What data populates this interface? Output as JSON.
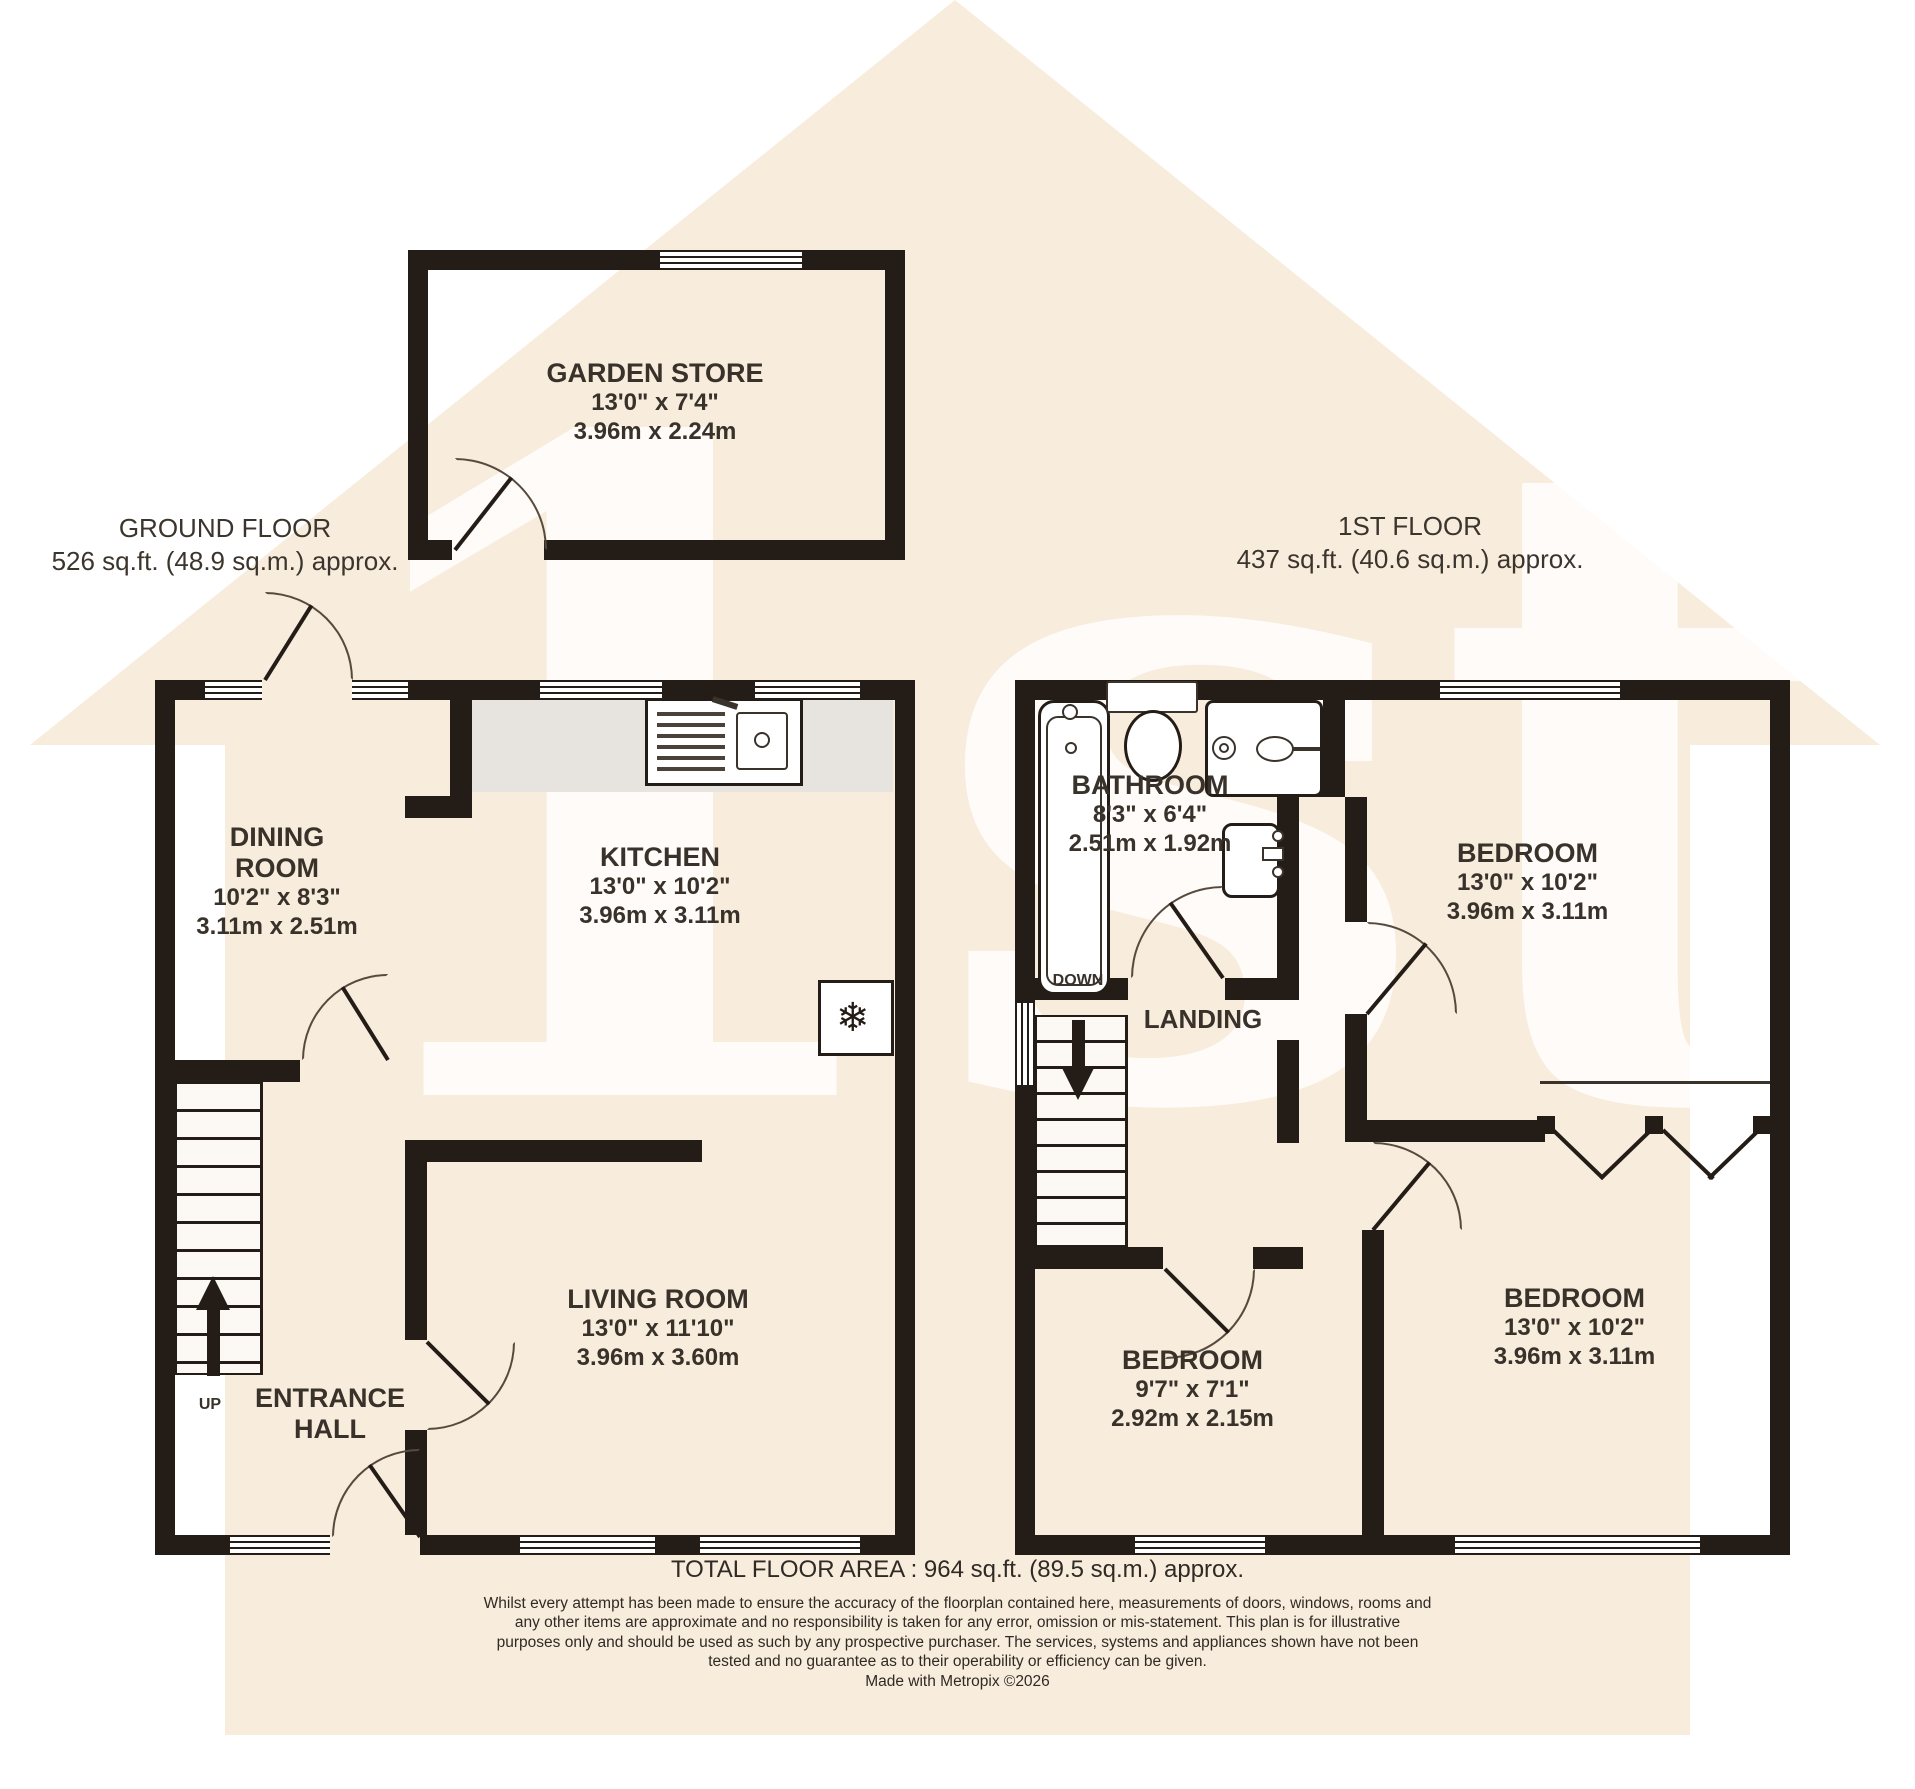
{
  "watermark": {
    "text": "1st"
  },
  "headings": {
    "ground": {
      "title": "GROUND FLOOR",
      "area": "526 sq.ft. (48.9 sq.m.) approx."
    },
    "first": {
      "title": "1ST FLOOR",
      "area": "437 sq.ft. (40.6 sq.m.) approx."
    }
  },
  "rooms": {
    "garden_store": {
      "name": "GARDEN STORE",
      "imperial": "13'0\" x 7'4\"",
      "metric": "3.96m x 2.24m"
    },
    "dining_room": {
      "name": "DINING ROOM",
      "imperial": "10'2\" x 8'3\"",
      "metric": "3.11m x 2.51m"
    },
    "kitchen": {
      "name": "KITCHEN",
      "imperial": "13'0\" x 10'2\"",
      "metric": "3.96m x 3.11m"
    },
    "living_room": {
      "name": "LIVING ROOM",
      "imperial": "13'0\" x 11'10\"",
      "metric": "3.96m x 3.60m"
    },
    "entrance_hall": {
      "name": "ENTRANCE HALL"
    },
    "bathroom": {
      "name": "BATHROOM",
      "imperial": "8'3\" x 6'4\"",
      "metric": "2.51m x 1.92m"
    },
    "bedroom_front": {
      "name": "BEDROOM",
      "imperial": "13'0\" x 10'2\"",
      "metric": "3.96m x 3.11m"
    },
    "bedroom_middle": {
      "name": "BEDROOM",
      "imperial": "9'7\" x 7'1\"",
      "metric": "2.92m x 2.15m"
    },
    "bedroom_back": {
      "name": "BEDROOM",
      "imperial": "13'0\" x 10'2\"",
      "metric": "3.96m x 3.11m"
    },
    "landing": {
      "name": "LANDING"
    }
  },
  "stairs": {
    "up": "UP",
    "down": "DOWN"
  },
  "icons": {
    "snowflake": "❄"
  },
  "footer": {
    "total": "TOTAL FLOOR AREA : 964 sq.ft. (89.5 sq.m.) approx.",
    "disclaimer": "Whilst every attempt has been made to ensure the accuracy of the floorplan contained here, measurements of doors, windows, rooms and any other items are approximate and no responsibility is taken for any error, omission or mis-statement. This plan is for illustrative purposes only and should be used as such by any prospective purchaser. The services, systems and appliances shown have not been tested and no guarantee as to their operability or efficiency can be given.",
    "credit": "Made with Metropix ©2026"
  },
  "colors": {
    "wall": "#241d17",
    "watermark": "#f8ecdc",
    "counter": "#e7e4df"
  }
}
